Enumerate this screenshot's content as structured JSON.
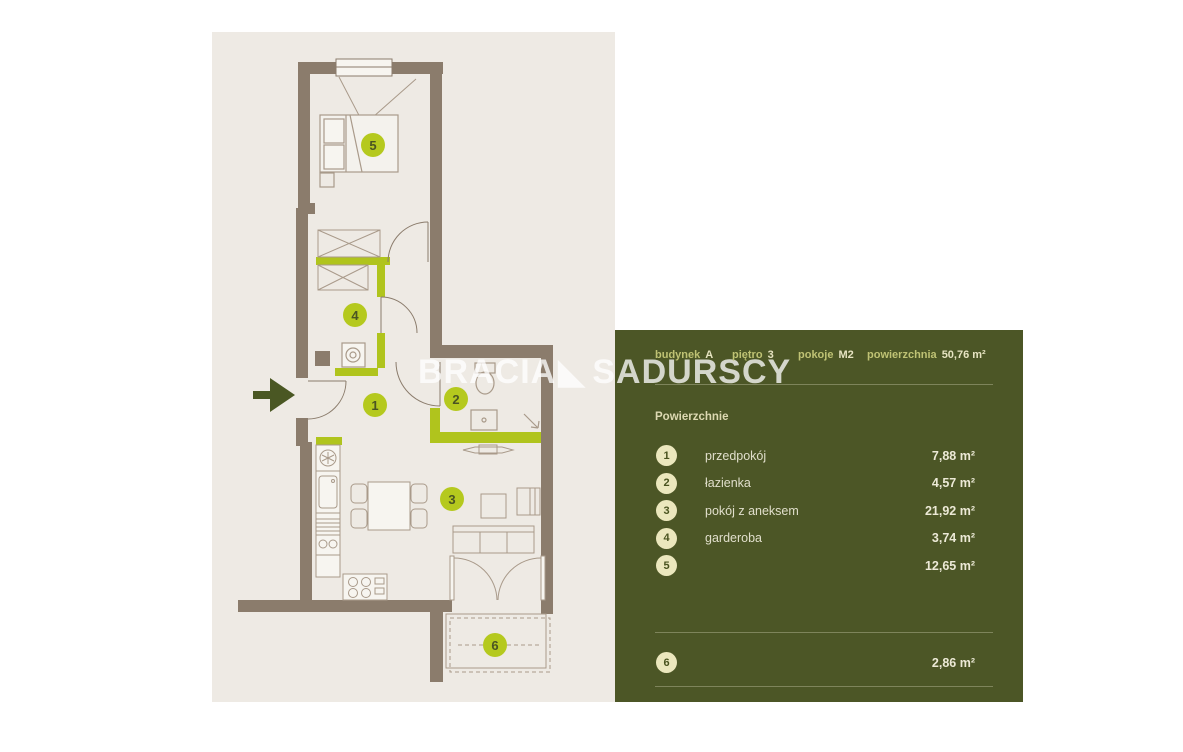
{
  "watermark": {
    "part1": "BRACIA",
    "part2": "SADURSCY",
    "logo_icon": "black-lower-left-triangle"
  },
  "panel": {
    "header": {
      "building_label": "budynek",
      "building_value": "A",
      "floor_label": "piętro",
      "floor_value": "3",
      "rooms_label": "pokoje",
      "rooms_value": "M2",
      "area_label": "powierzchnia",
      "area_value": "50,76 m²"
    },
    "section_title": "Powierzchnie",
    "rooms": [
      {
        "num": "1",
        "name": "przedpokój",
        "area": "7,88 m²"
      },
      {
        "num": "2",
        "name": "łazienka",
        "area": "4,57 m²"
      },
      {
        "num": "3",
        "name": "pokój z aneksem",
        "area": "21,92 m²"
      },
      {
        "num": "4",
        "name": "garderoba",
        "area": "3,74 m²"
      },
      {
        "num": "5",
        "name": "",
        "area": "12,65 m²"
      },
      {
        "num": "6",
        "name": "",
        "area": "2,86 m²"
      }
    ]
  },
  "colors": {
    "panel_green": "#4c5626",
    "plan_beige": "#eeeae4",
    "wall_brown": "#8b7c6c",
    "accent_lime": "#b5c91e",
    "badge_cream": "#ebe7bd",
    "arrow_olive": "#4a5723"
  }
}
